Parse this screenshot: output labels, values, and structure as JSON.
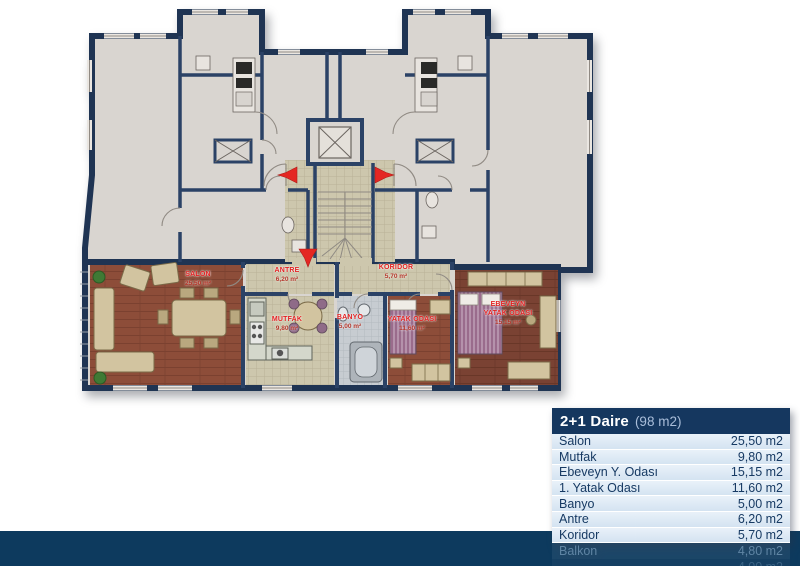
{
  "plan": {
    "description": "apartment floor plan",
    "rooms": [
      {
        "name": "SALON",
        "area": "25,50 m²"
      },
      {
        "name": "ANTRE",
        "area": "6,20 m²"
      },
      {
        "name": "KORIDOR",
        "area": "5,70 m²"
      },
      {
        "name": "MUTFAK",
        "area": "9,80 m²"
      },
      {
        "name": "BANYO",
        "area": "5,00 m²"
      },
      {
        "name": "YATAK ODASI",
        "area": "11,60 m²"
      },
      {
        "name": "EBEVEYN",
        "name2": "YATAK ODASI",
        "area": "15,15 m²"
      }
    ],
    "icons": [
      "entry-arrow-left",
      "entry-arrow-right",
      "entry-arrow-down"
    ]
  },
  "legend": {
    "title": "2+1 Daire",
    "subtitle": "(98 m2)",
    "rows": [
      {
        "label": "Salon",
        "value": "25,50 m2"
      },
      {
        "label": "Mutfak",
        "value": "9,80 m2"
      },
      {
        "label": "Ebeveyn Y. Odası",
        "value": "15,15 m2"
      },
      {
        "label": "1. Yatak Odası",
        "value": "11,60 m2"
      },
      {
        "label": "Banyo",
        "value": "5,00 m2"
      },
      {
        "label": "Antre",
        "value": "6,20 m2"
      },
      {
        "label": "Koridor",
        "value": "5,70 m2"
      },
      {
        "label": "Balkon",
        "value": "4,80 m2"
      },
      {
        "label": "",
        "value": "4,00 m2"
      }
    ]
  },
  "palette": {
    "wall_navy": "#1f3453",
    "footer_navy": "#0d3a5e",
    "header_navy": "#15375f",
    "row_blue": "#d4e3f1",
    "row_text": "#173a63",
    "floor_gray": "#d9d5d0",
    "tile_beige": "#cdc7ad",
    "wood_brown": "#8d4d39",
    "wood_dark": "#7a4233",
    "label_red": "#e21f1f",
    "arrow_red": "#e42723"
  }
}
